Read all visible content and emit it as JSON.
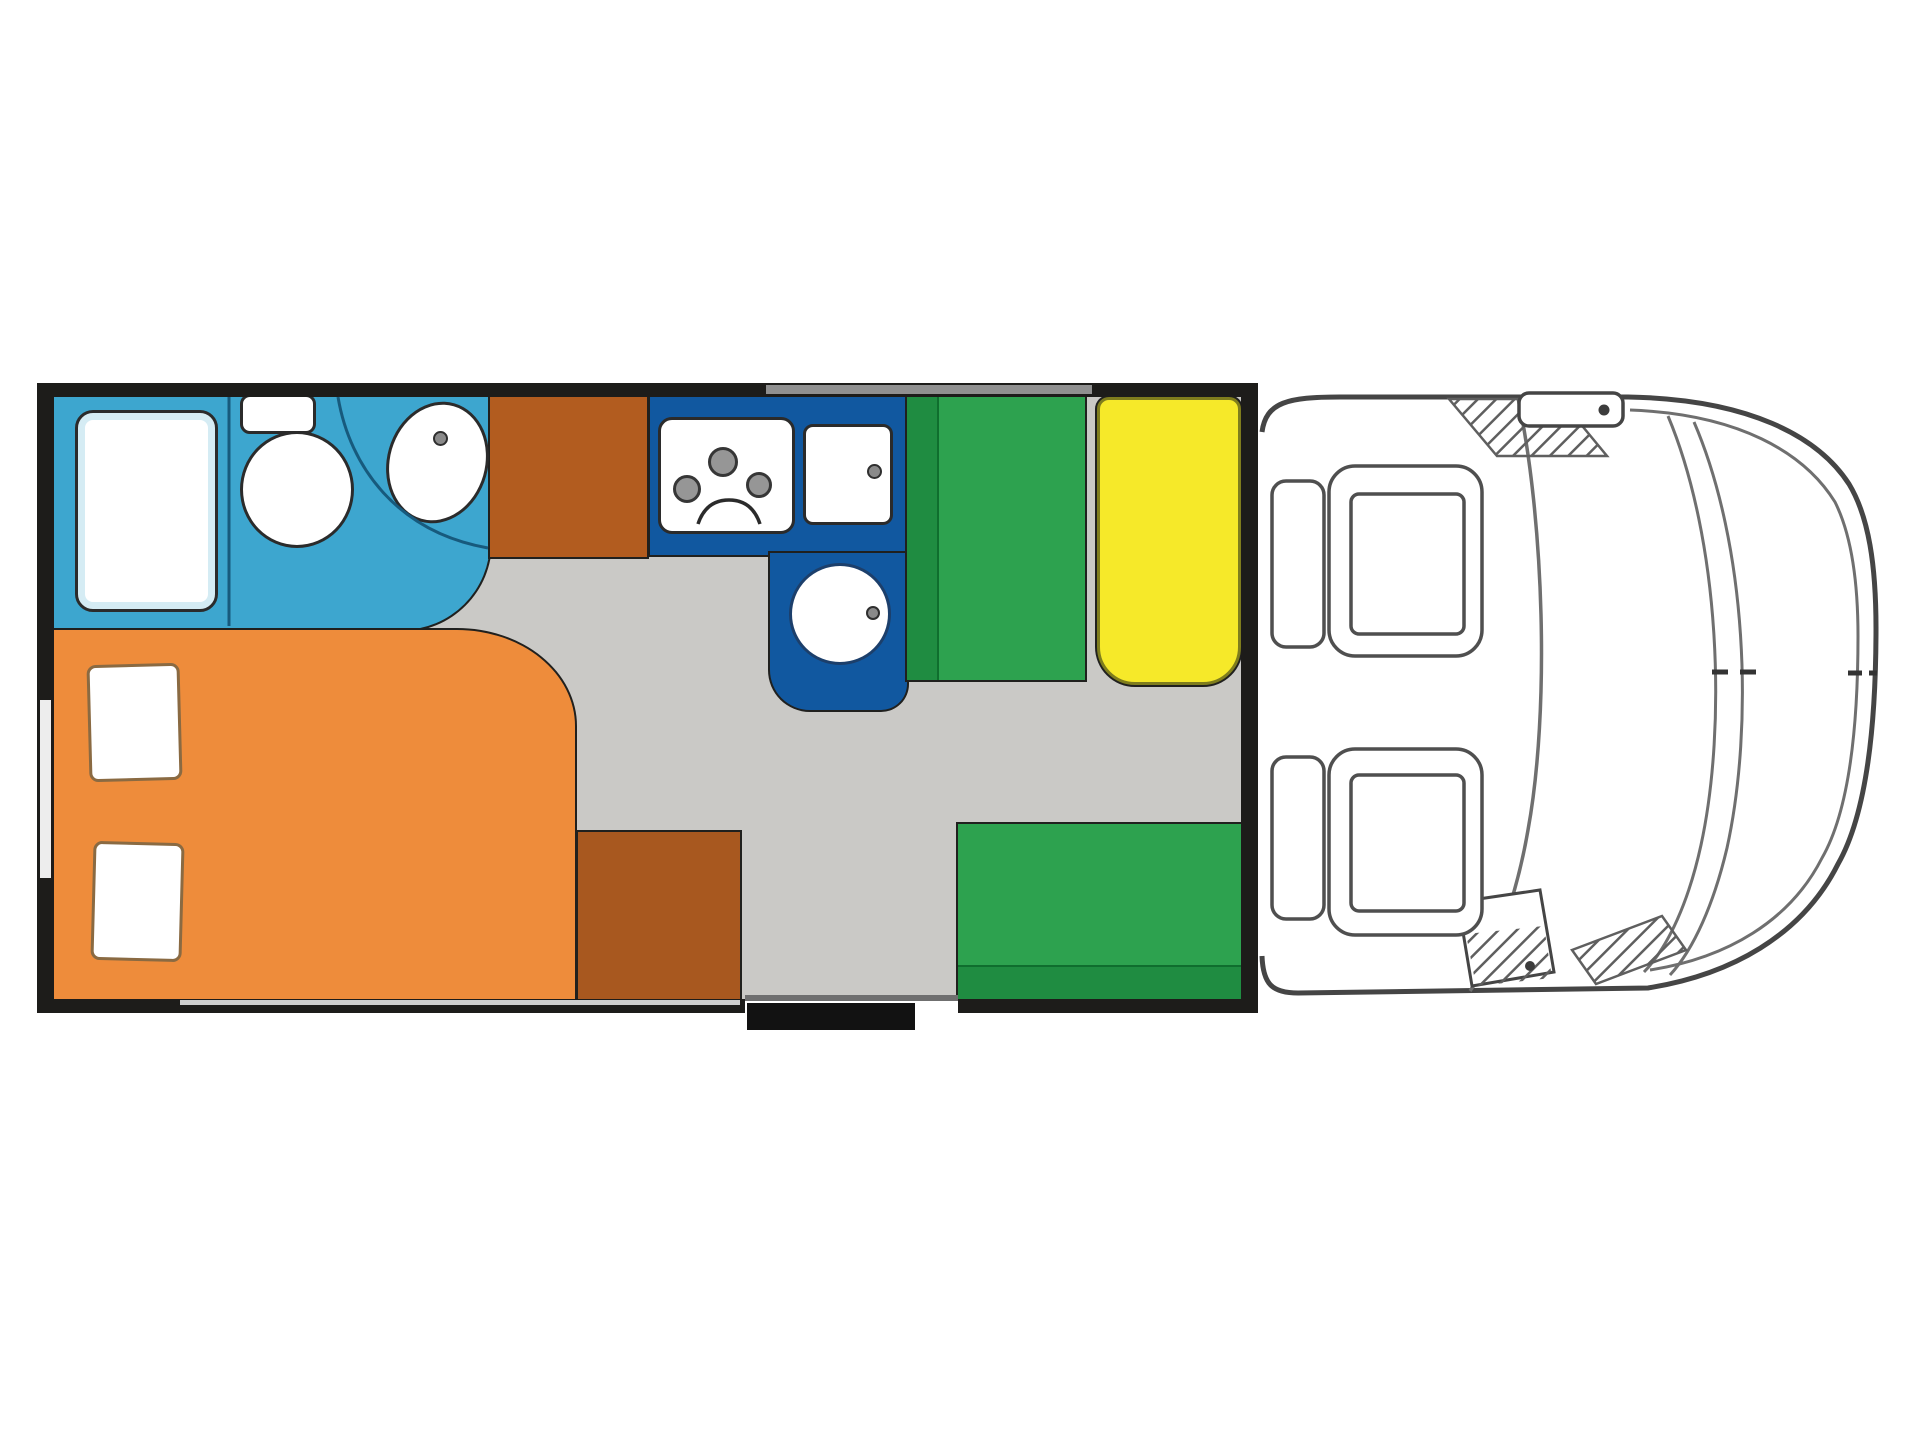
{
  "floorplan": {
    "vehicle": "motorhome",
    "view": "top-down-layout",
    "zones": [
      {
        "id": "bathroom",
        "label": "bathroom",
        "fixtures": [
          "shower-tray",
          "toilet",
          "washbasin"
        ]
      },
      {
        "id": "rear-bed",
        "label": "double-bed",
        "pillows": 2
      },
      {
        "id": "wardrobe-rear",
        "label": "wardrobe-block"
      },
      {
        "id": "wardrobe-entry",
        "label": "wardrobe-block"
      },
      {
        "id": "kitchen",
        "label": "kitchen-l-counter",
        "hob_burners": 3,
        "sinks": 2
      },
      {
        "id": "dinette",
        "label": "dinette",
        "benches": 2,
        "table": 1
      },
      {
        "id": "entry",
        "label": "entry-door-with-step"
      },
      {
        "id": "cab",
        "label": "driver-cab",
        "seats": 2,
        "mirrors": 2
      }
    ]
  },
  "palette": {
    "background": "#ffffff",
    "floor": "#cac9c6",
    "bathroom": "#3da6cf",
    "bathroom_line": "#175a7d",
    "bed": "#ee8c3b",
    "pillow": "#ffffff",
    "wardrobe_top": "#b25c1f",
    "wardrobe_bottom": "#a8581f",
    "kitchen": "#1158a0",
    "bench": "#2da24f",
    "bench_dark": "#1f8c41",
    "table": "#f6e929",
    "table_border": "#7f7d1d",
    "wall": "#1d1c1a",
    "window": "#909090",
    "window_pale": "#ededed",
    "step": "#121212",
    "fixture_fill": "#ffffff",
    "fixture_stroke": "#2b2b2b",
    "burner": "#969696",
    "faucet_dot": "#8a8a8a",
    "cab_line": "#454545",
    "cab_line_light": "#6f6f6f",
    "hatch": "#5f5f5f",
    "seat_line": "#4f4f4f"
  }
}
